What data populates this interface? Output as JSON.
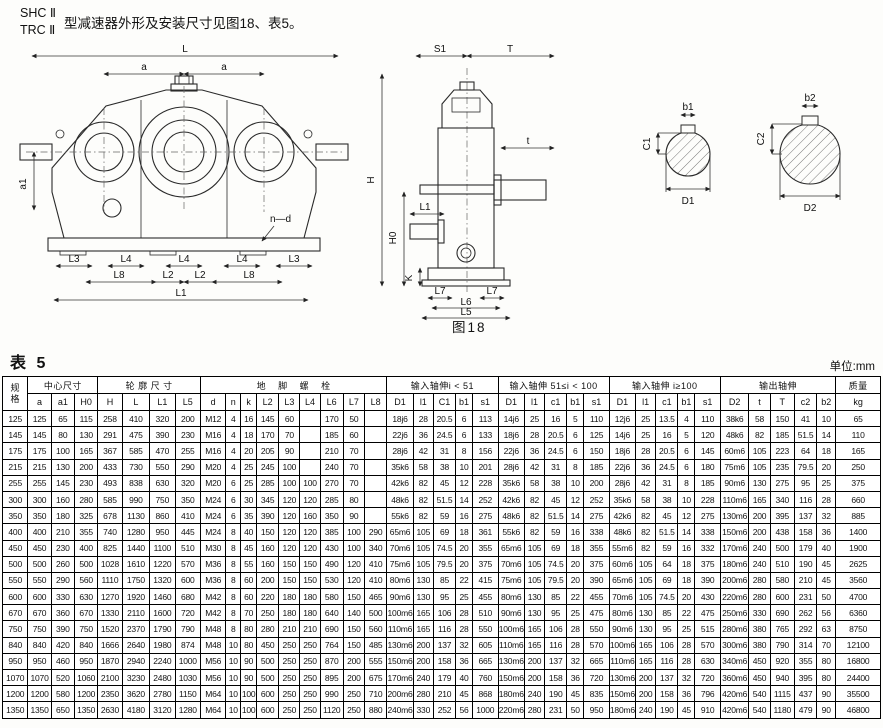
{
  "header": {
    "model_line1": "SHC Ⅱ",
    "model_line2": "TRC Ⅱ",
    "description": "型减速器外形及安装尺寸见图18、表5。"
  },
  "figure": {
    "caption": "图18",
    "front": {
      "L": "L",
      "a": "a",
      "a1": "a1",
      "n_d": "n—d",
      "L3": "L3",
      "L4": "L4",
      "L8": "L8",
      "L2": "L2",
      "L1": "L1"
    },
    "side": {
      "S1": "S1",
      "T": "T",
      "t": "t",
      "H": "H",
      "H0": "H0",
      "K": "K",
      "L1": "L1",
      "L7": "L7",
      "L6": "L6",
      "L5": "L5"
    },
    "sec1": {
      "b1": "b1",
      "C1": "C1",
      "D1": "D1"
    },
    "sec2": {
      "b2": "b2",
      "C2": "C2",
      "D2": "D2"
    }
  },
  "table": {
    "title": "表 5",
    "unit": "单位:mm",
    "header_groups": [
      {
        "label": "规\n格",
        "rowspan": 2
      },
      {
        "label": "中心尺寸",
        "cols": [
          "a",
          "a1",
          "H0"
        ]
      },
      {
        "label": "轮 廓 尺 寸",
        "cols": [
          "H",
          "L",
          "L1",
          "L5"
        ]
      },
      {
        "label": "地    脚    螺    栓",
        "cols": [
          "d",
          "n",
          "k",
          "L2",
          "L3",
          "L4",
          "L6",
          "L7",
          "L8"
        ]
      },
      {
        "label": "输入轴伸i < 51",
        "cols": [
          "D1",
          "l1",
          "C1",
          "b1",
          "s1"
        ]
      },
      {
        "label": "输入轴伸 51≤i < 100",
        "cols": [
          "D1",
          "l1",
          "c1",
          "b1",
          "s1"
        ]
      },
      {
        "label": "输入轴伸 i≥100",
        "cols": [
          "D1",
          "l1",
          "c1",
          "b1",
          "s1"
        ]
      },
      {
        "label": "输出轴伸",
        "cols": [
          "D2",
          "t",
          "T",
          "c2",
          "b2"
        ]
      },
      {
        "label": "质量",
        "sub": "kg"
      }
    ],
    "rows": [
      [
        "125",
        "125",
        "65",
        "115",
        "258",
        "410",
        "320",
        "200",
        "M12",
        "4",
        "16",
        "145",
        "60",
        "",
        "170",
        "50",
        "",
        "18j6",
        "28",
        "20.5",
        "6",
        "113",
        "14j6",
        "25",
        "16",
        "5",
        "110",
        "12j6",
        "25",
        "13.5",
        "4",
        "110",
        "38k6",
        "58",
        "150",
        "41",
        "10",
        "65"
      ],
      [
        "145",
        "145",
        "80",
        "130",
        "291",
        "475",
        "390",
        "230",
        "M16",
        "4",
        "18",
        "170",
        "70",
        "",
        "185",
        "60",
        "",
        "22j6",
        "36",
        "24.5",
        "6",
        "133",
        "18j6",
        "28",
        "20.5",
        "6",
        "125",
        "14j6",
        "25",
        "16",
        "5",
        "120",
        "48k6",
        "82",
        "185",
        "51.5",
        "14",
        "110"
      ],
      [
        "175",
        "175",
        "100",
        "165",
        "367",
        "585",
        "470",
        "255",
        "M16",
        "4",
        "20",
        "205",
        "90",
        "",
        "210",
        "70",
        "",
        "28j6",
        "42",
        "31",
        "8",
        "156",
        "22j6",
        "36",
        "24.5",
        "6",
        "150",
        "18j6",
        "28",
        "20.5",
        "6",
        "145",
        "60m6",
        "105",
        "223",
        "64",
        "18",
        "165"
      ],
      [
        "215",
        "215",
        "130",
        "200",
        "433",
        "730",
        "550",
        "290",
        "M20",
        "4",
        "25",
        "245",
        "100",
        "",
        "240",
        "70",
        "",
        "35k6",
        "58",
        "38",
        "10",
        "201",
        "28j6",
        "42",
        "31",
        "8",
        "185",
        "22j6",
        "36",
        "24.5",
        "6",
        "180",
        "75m6",
        "105",
        "235",
        "79.5",
        "20",
        "250"
      ],
      [
        "255",
        "255",
        "145",
        "230",
        "493",
        "838",
        "630",
        "320",
        "M20",
        "6",
        "25",
        "285",
        "100",
        "100",
        "270",
        "70",
        "",
        "42k6",
        "82",
        "45",
        "12",
        "228",
        "35k6",
        "58",
        "38",
        "10",
        "200",
        "28j6",
        "42",
        "31",
        "8",
        "185",
        "90m6",
        "130",
        "275",
        "95",
        "25",
        "375"
      ],
      [
        "300",
        "300",
        "160",
        "280",
        "585",
        "990",
        "750",
        "350",
        "M24",
        "6",
        "30",
        "345",
        "120",
        "120",
        "285",
        "80",
        "",
        "48k6",
        "82",
        "51.5",
        "14",
        "252",
        "42k6",
        "82",
        "45",
        "12",
        "252",
        "35k6",
        "58",
        "38",
        "10",
        "228",
        "110m6",
        "165",
        "340",
        "116",
        "28",
        "660"
      ],
      [
        "350",
        "350",
        "180",
        "325",
        "678",
        "1130",
        "860",
        "410",
        "M24",
        "6",
        "35",
        "390",
        "120",
        "160",
        "350",
        "90",
        "",
        "55k6",
        "82",
        "59",
        "16",
        "275",
        "48k6",
        "82",
        "51.5",
        "14",
        "275",
        "42k6",
        "82",
        "45",
        "12",
        "275",
        "130m6",
        "200",
        "395",
        "137",
        "32",
        "885"
      ],
      [
        "400",
        "400",
        "210",
        "355",
        "740",
        "1280",
        "950",
        "445",
        "M24",
        "8",
        "40",
        "150",
        "120",
        "120",
        "385",
        "100",
        "290",
        "65m6",
        "105",
        "69",
        "18",
        "361",
        "55k6",
        "82",
        "59",
        "16",
        "338",
        "48k6",
        "82",
        "51.5",
        "14",
        "338",
        "150m6",
        "200",
        "438",
        "158",
        "36",
        "1400"
      ],
      [
        "450",
        "450",
        "230",
        "400",
        "825",
        "1440",
        "1100",
        "510",
        "M30",
        "8",
        "45",
        "160",
        "120",
        "120",
        "430",
        "100",
        "340",
        "70m6",
        "105",
        "74.5",
        "20",
        "355",
        "65m6",
        "105",
        "69",
        "18",
        "355",
        "55m6",
        "82",
        "59",
        "16",
        "332",
        "170m6",
        "240",
        "500",
        "179",
        "40",
        "1900"
      ],
      [
        "500",
        "500",
        "260",
        "500",
        "1028",
        "1610",
        "1220",
        "570",
        "M36",
        "8",
        "55",
        "160",
        "150",
        "150",
        "490",
        "120",
        "410",
        "75m6",
        "105",
        "79.5",
        "20",
        "375",
        "70m6",
        "105",
        "74.5",
        "20",
        "375",
        "60m6",
        "105",
        "64",
        "18",
        "375",
        "180m6",
        "240",
        "510",
        "190",
        "45",
        "2625"
      ],
      [
        "550",
        "550",
        "290",
        "560",
        "1110",
        "1750",
        "1320",
        "600",
        "M36",
        "8",
        "60",
        "200",
        "150",
        "150",
        "530",
        "120",
        "410",
        "80m6",
        "130",
        "85",
        "22",
        "415",
        "75m6",
        "105",
        "79.5",
        "20",
        "390",
        "65m6",
        "105",
        "69",
        "18",
        "390",
        "200m6",
        "280",
        "580",
        "210",
        "45",
        "3560"
      ],
      [
        "600",
        "600",
        "330",
        "630",
        "1270",
        "1920",
        "1460",
        "680",
        "M42",
        "8",
        "60",
        "220",
        "180",
        "180",
        "580",
        "150",
        "465",
        "90m6",
        "130",
        "95",
        "25",
        "455",
        "80m6",
        "130",
        "85",
        "22",
        "455",
        "70m6",
        "105",
        "74.5",
        "20",
        "430",
        "220m6",
        "280",
        "600",
        "231",
        "50",
        "4700"
      ],
      [
        "670",
        "670",
        "360",
        "670",
        "1330",
        "2110",
        "1600",
        "720",
        "M42",
        "8",
        "70",
        "250",
        "180",
        "180",
        "640",
        "140",
        "500",
        "100m6",
        "165",
        "106",
        "28",
        "510",
        "90m6",
        "130",
        "95",
        "25",
        "475",
        "80m6",
        "130",
        "85",
        "22",
        "475",
        "250m6",
        "330",
        "690",
        "262",
        "56",
        "6360"
      ],
      [
        "750",
        "750",
        "390",
        "750",
        "1520",
        "2370",
        "1790",
        "790",
        "M48",
        "8",
        "80",
        "280",
        "210",
        "210",
        "690",
        "150",
        "560",
        "110m6",
        "165",
        "116",
        "28",
        "550",
        "100m6",
        "165",
        "106",
        "28",
        "550",
        "90m6",
        "130",
        "95",
        "25",
        "515",
        "280m6",
        "380",
        "765",
        "292",
        "63",
        "8750"
      ],
      [
        "840",
        "840",
        "420",
        "840",
        "1666",
        "2640",
        "1980",
        "874",
        "M48",
        "10",
        "80",
        "450",
        "250",
        "250",
        "764",
        "150",
        "485",
        "130m6",
        "200",
        "137",
        "32",
        "605",
        "110m6",
        "165",
        "116",
        "28",
        "570",
        "100m6",
        "165",
        "106",
        "28",
        "570",
        "300m6",
        "380",
        "790",
        "314",
        "70",
        "12100"
      ],
      [
        "950",
        "950",
        "460",
        "950",
        "1870",
        "2940",
        "2240",
        "1000",
        "M56",
        "10",
        "90",
        "500",
        "250",
        "250",
        "870",
        "200",
        "555",
        "150m6",
        "200",
        "158",
        "36",
        "665",
        "130m6",
        "200",
        "137",
        "32",
        "665",
        "110m6",
        "165",
        "116",
        "28",
        "630",
        "340m6",
        "450",
        "920",
        "355",
        "80",
        "16800"
      ],
      [
        "1070",
        "1070",
        "520",
        "1060",
        "2100",
        "3230",
        "2480",
        "1030",
        "M56",
        "10",
        "90",
        "500",
        "250",
        "250",
        "895",
        "200",
        "675",
        "170m6",
        "240",
        "179",
        "40",
        "760",
        "150m6",
        "200",
        "158",
        "36",
        "720",
        "130m6",
        "200",
        "137",
        "32",
        "720",
        "360m6",
        "450",
        "940",
        "395",
        "80",
        "24400"
      ],
      [
        "1200",
        "1200",
        "580",
        "1200",
        "2350",
        "3620",
        "2780",
        "1150",
        "M64",
        "10",
        "100",
        "600",
        "250",
        "250",
        "990",
        "250",
        "710",
        "200m6",
        "280",
        "210",
        "45",
        "868",
        "180m6",
        "240",
        "190",
        "45",
        "835",
        "150m6",
        "200",
        "158",
        "36",
        "796",
        "420m6",
        "540",
        "1115",
        "437",
        "90",
        "35500"
      ],
      [
        "1350",
        "1350",
        "650",
        "1350",
        "2630",
        "4180",
        "3120",
        "1280",
        "M64",
        "10",
        "100",
        "600",
        "250",
        "250",
        "1120",
        "250",
        "880",
        "240m6",
        "330",
        "252",
        "56",
        "1000",
        "220m6",
        "280",
        "231",
        "50",
        "950",
        "180m6",
        "240",
        "190",
        "45",
        "910",
        "420m6",
        "540",
        "1180",
        "479",
        "90",
        "46800"
      ]
    ]
  }
}
